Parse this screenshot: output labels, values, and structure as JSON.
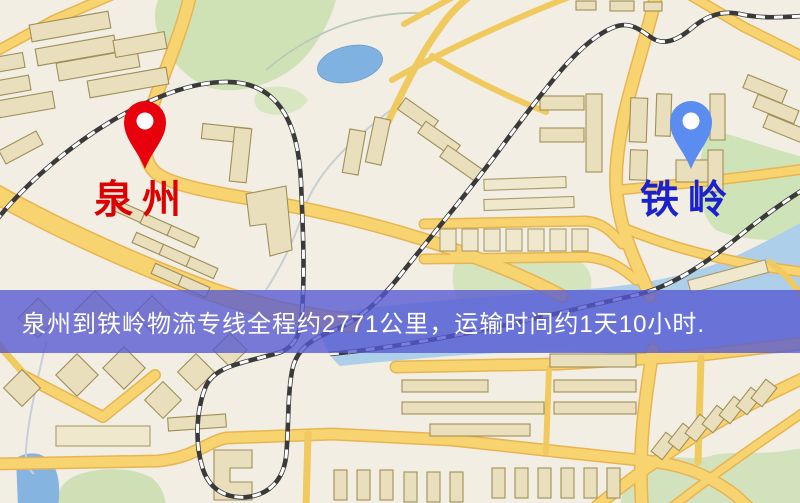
{
  "map": {
    "type": "static-route-map",
    "background_color": "#f2eee3",
    "road_color": "#f7d470",
    "road_casing_color": "#e8b452",
    "railway_color": "#3a3a3a",
    "water_color": "#86b4e0",
    "park_color": "#cfe2b6",
    "building_color": "#e9dfbc"
  },
  "markers": {
    "origin": {
      "label": "泉州",
      "label_color": "#dd0000",
      "pin_color": "#e8000d"
    },
    "destination": {
      "label": "铁岭",
      "label_color": "#1b22cc",
      "pin_color": "#5b8cf0"
    }
  },
  "banner": {
    "text": "泉州到铁岭物流专线全程约2771公里，运输时间约1天10小时.",
    "background_color": "rgba(86,88,210,0.78)",
    "text_color": "#ffffff"
  }
}
